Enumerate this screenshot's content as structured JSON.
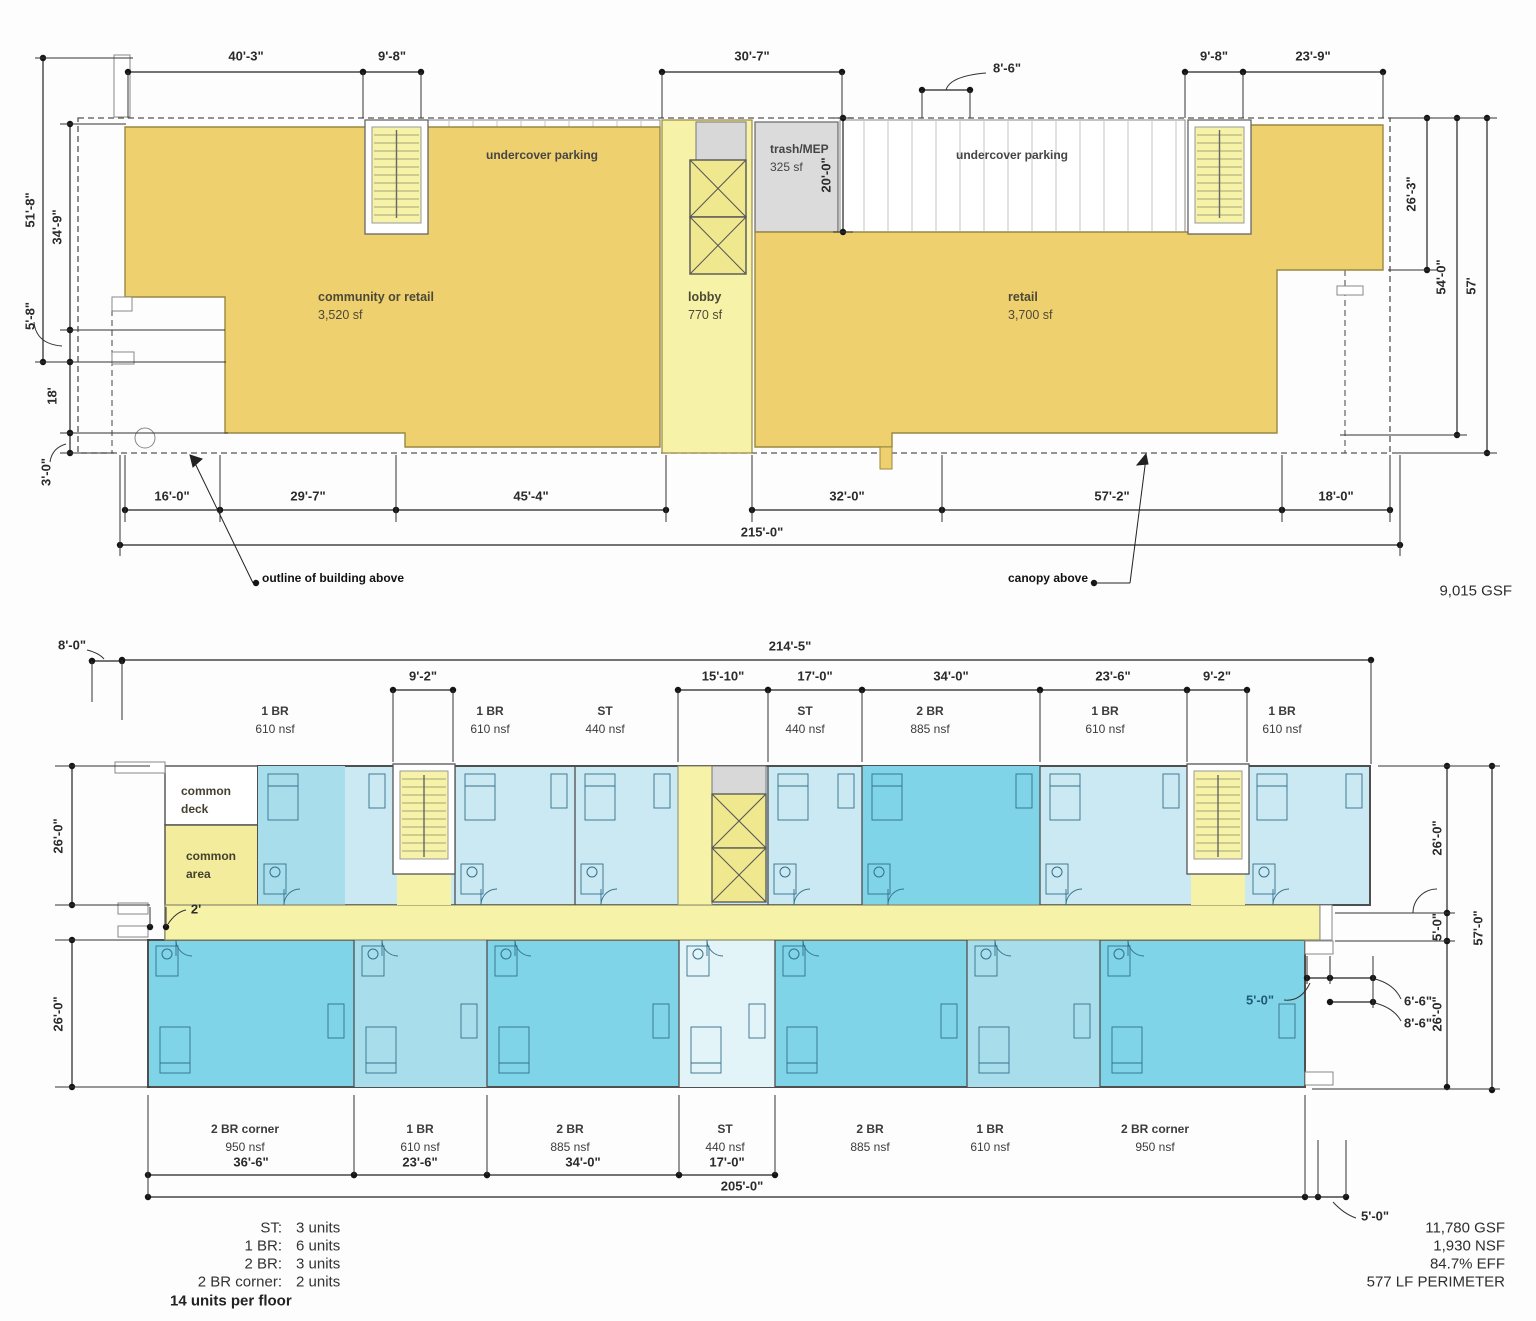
{
  "drawing_title": "residential building floor plans",
  "colors": {
    "retail_yellow": "#EFD06F",
    "pale_yellow": "#F6F2A8",
    "bright_yellow": "#F2EC9C",
    "elevator_yellow": "#F0E88E",
    "unit_light": "#CBE9F2",
    "unit_medium": "#A8DEEC",
    "unit_dark": "#7FD4E7",
    "unit_pale": "#E3F4F9",
    "gray_mep": "#DBDBDB",
    "wall": "#4f4f4f",
    "dim": "#222222",
    "furniture": "#34708A",
    "hatch": "#c6c6c6",
    "dim_text_blue": "#1d5b77"
  },
  "ground_floor": {
    "labels": [
      {
        "n": "dim-40-3",
        "t": "40'-3\"",
        "x": 246,
        "y": 56
      },
      {
        "n": "dim-9-8-left",
        "t": "9'-8\"",
        "x": 392,
        "y": 56
      },
      {
        "n": "dim-30-7",
        "t": "30'-7\"",
        "x": 752,
        "y": 56
      },
      {
        "n": "dim-8-6-top",
        "t": "8'-6\"",
        "x": 1007,
        "y": 68
      },
      {
        "n": "dim-9-8-right",
        "t": "9'-8\"",
        "x": 1214,
        "y": 56
      },
      {
        "n": "dim-23-9",
        "t": "23'-9\"",
        "x": 1313,
        "y": 56
      },
      {
        "n": "dim-51-8",
        "t": "51'-8\"",
        "x": 30,
        "y": 210,
        "r": -90
      },
      {
        "n": "dim-34-9",
        "t": "34'-9\"",
        "x": 57,
        "y": 227,
        "r": -90
      },
      {
        "n": "dim-5-8",
        "t": "5'-8\"",
        "x": 30,
        "y": 316,
        "r": -90
      },
      {
        "n": "dim-18",
        "t": "18'",
        "x": 52,
        "y": 396,
        "r": -90
      },
      {
        "n": "dim-3-0",
        "t": "3'-0\"",
        "x": 46,
        "y": 472,
        "r": -90
      },
      {
        "n": "dim-20-0",
        "t": "20'-0\"",
        "x": 826,
        "y": 175,
        "r": -90
      },
      {
        "n": "dim-26-3",
        "t": "26'-3\"",
        "x": 1411,
        "y": 194,
        "r": -90
      },
      {
        "n": "dim-54-0",
        "t": "54'-0\"",
        "x": 1441,
        "y": 277,
        "r": -90
      },
      {
        "n": "dim-57",
        "t": "57'",
        "x": 1471,
        "y": 286,
        "r": -90
      },
      {
        "n": "dim-16-0",
        "t": "16'-0\"",
        "x": 172,
        "y": 496
      },
      {
        "n": "dim-29-7",
        "t": "29'-7\"",
        "x": 308,
        "y": 496
      },
      {
        "n": "dim-45-4",
        "t": "45'-4\"",
        "x": 531,
        "y": 496
      },
      {
        "n": "dim-32-0",
        "t": "32'-0\"",
        "x": 847,
        "y": 496
      },
      {
        "n": "dim-57-2",
        "t": "57'-2\"",
        "x": 1112,
        "y": 496
      },
      {
        "n": "dim-18-0",
        "t": "18'-0\"",
        "x": 1336,
        "y": 496
      },
      {
        "n": "dim-215-0",
        "t": "215'-0\"",
        "x": 762,
        "y": 532
      },
      {
        "n": "room-community-retail",
        "t": "community or retail",
        "x": 318,
        "y": 297,
        "a": "left",
        "s": 12.5,
        "w": 700,
        "c": "#4d4936"
      },
      {
        "n": "room-community-retail-area",
        "t": "3,520 sf",
        "x": 318,
        "y": 315,
        "a": "left",
        "s": 12.5,
        "w": 400,
        "c": "#4d4936"
      },
      {
        "n": "room-lobby",
        "t": "lobby",
        "x": 688,
        "y": 297,
        "a": "left",
        "s": 12.5,
        "w": 700,
        "c": "#4d4936"
      },
      {
        "n": "room-lobby-area",
        "t": "770 sf",
        "x": 688,
        "y": 315,
        "a": "left",
        "s": 12.5,
        "w": 400,
        "c": "#4d4936"
      },
      {
        "n": "room-retail",
        "t": "retail",
        "x": 1008,
        "y": 297,
        "a": "left",
        "s": 12.5,
        "w": 700,
        "c": "#4d4936"
      },
      {
        "n": "room-retail-area",
        "t": "3,700 sf",
        "x": 1008,
        "y": 315,
        "a": "left",
        "s": 12.5,
        "w": 400,
        "c": "#4d4936"
      },
      {
        "n": "room-trash-mep",
        "t": "trash/MEP",
        "x": 770,
        "y": 149,
        "a": "left",
        "s": 12,
        "w": 700,
        "c": "#454545"
      },
      {
        "n": "room-trash-mep-area",
        "t": "325 sf",
        "x": 770,
        "y": 167,
        "a": "left",
        "s": 12,
        "w": 400,
        "c": "#454545"
      },
      {
        "n": "label-undercover-parking-left",
        "t": "undercover parking",
        "x": 542,
        "y": 155,
        "s": 12,
        "w": 600,
        "c": "#454545"
      },
      {
        "n": "label-undercover-parking-right",
        "t": "undercover parking",
        "x": 1012,
        "y": 155,
        "s": 12,
        "w": 600,
        "c": "#454545"
      },
      {
        "n": "note-outline-of-building-above",
        "t": "outline of building above",
        "x": 262,
        "y": 578,
        "a": "left",
        "s": 12,
        "w": 700,
        "c": "#111111"
      },
      {
        "n": "note-canopy-above",
        "t": "canopy above",
        "x": 1088,
        "y": 578,
        "a": "right",
        "s": 12,
        "w": 700,
        "c": "#111111"
      },
      {
        "n": "stat-ground-gsf",
        "t": "9,015 GSF",
        "x": 1512,
        "y": 591,
        "a": "right",
        "s": 15,
        "w": 400,
        "c": "#2e2e2e"
      }
    ]
  },
  "upper_floor": {
    "labels": [
      {
        "n": "dim-8-0",
        "t": "8'-0\"",
        "x": 72,
        "y": 645
      },
      {
        "n": "dim-214-5",
        "t": "214'-5\"",
        "x": 790,
        "y": 646
      },
      {
        "n": "dim-9-2-left",
        "t": "9'-2\"",
        "x": 423,
        "y": 676
      },
      {
        "n": "dim-15-10",
        "t": "15'-10\"",
        "x": 723,
        "y": 676
      },
      {
        "n": "dim-17-0-top",
        "t": "17'-0\"",
        "x": 815,
        "y": 676
      },
      {
        "n": "dim-34-0-top",
        "t": "34'-0\"",
        "x": 951,
        "y": 676
      },
      {
        "n": "dim-23-6-top",
        "t": "23'-6\"",
        "x": 1113,
        "y": 676
      },
      {
        "n": "dim-9-2-right",
        "t": "9'-2\"",
        "x": 1217,
        "y": 676
      },
      {
        "n": "dim-26-0-left-top",
        "t": "26'-0\"",
        "x": 58,
        "y": 836,
        "r": -90
      },
      {
        "n": "dim-26-0-left-bottom",
        "t": "26'-0\"",
        "x": 58,
        "y": 1014,
        "r": -90
      },
      {
        "n": "dim-2ft",
        "t": "2'",
        "x": 196,
        "y": 909,
        "s": 13,
        "w": 600
      },
      {
        "n": "dim-26-0-right-top",
        "t": "26'-0\"",
        "x": 1437,
        "y": 838,
        "r": -90
      },
      {
        "n": "dim-5-0-right",
        "t": "5'-0\"",
        "x": 1437,
        "y": 927,
        "r": -90
      },
      {
        "n": "dim-26-0-right-bottom",
        "t": "26'-0\"",
        "x": 1437,
        "y": 1014,
        "r": -90
      },
      {
        "n": "dim-57-0",
        "t": "57'-0\"",
        "x": 1478,
        "y": 928,
        "r": -90
      },
      {
        "n": "dim-6-6",
        "t": "6'-6\"",
        "x": 1404,
        "y": 1001,
        "a": "left"
      },
      {
        "n": "dim-8-6-right",
        "t": "8'-6\"",
        "x": 1404,
        "y": 1023,
        "a": "left"
      },
      {
        "n": "dim-5-0-in-unit",
        "t": "5'-0\"",
        "x": 1246,
        "y": 1000,
        "a": "left",
        "s": 13,
        "w": 700,
        "c": "#1d5b77"
      },
      {
        "n": "dim-36-6",
        "t": "36'-6\"",
        "x": 251,
        "y": 1162
      },
      {
        "n": "dim-23-6-bottom",
        "t": "23'-6\"",
        "x": 420,
        "y": 1162
      },
      {
        "n": "dim-34-0-bottom",
        "t": "34'-0\"",
        "x": 583,
        "y": 1162
      },
      {
        "n": "dim-17-0-bottom",
        "t": "17'-0\"",
        "x": 727,
        "y": 1162
      },
      {
        "n": "dim-205-0",
        "t": "205'-0\"",
        "x": 742,
        "y": 1186
      },
      {
        "n": "dim-5-0-bottom-right",
        "t": "5'-0\"",
        "x": 1361,
        "y": 1216,
        "a": "left"
      },
      {
        "n": "unit-top-1br-a",
        "t": "1 BR",
        "x": 275,
        "y": 711,
        "s": 12,
        "w": 700,
        "c": "#3c3c3c"
      },
      {
        "n": "unit-top-1br-a-area",
        "t": "610 nsf",
        "x": 275,
        "y": 729,
        "s": 12,
        "w": 400,
        "c": "#3c3c3c"
      },
      {
        "n": "unit-top-1br-b",
        "t": "1 BR",
        "x": 490,
        "y": 711,
        "s": 12,
        "w": 700,
        "c": "#3c3c3c"
      },
      {
        "n": "unit-top-1br-b-area",
        "t": "610 nsf",
        "x": 490,
        "y": 729,
        "s": 12,
        "w": 400,
        "c": "#3c3c3c"
      },
      {
        "n": "unit-top-st-a",
        "t": "ST",
        "x": 605,
        "y": 711,
        "s": 12,
        "w": 700,
        "c": "#3c3c3c"
      },
      {
        "n": "unit-top-st-a-area",
        "t": "440 nsf",
        "x": 605,
        "y": 729,
        "s": 12,
        "w": 400,
        "c": "#3c3c3c"
      },
      {
        "n": "unit-top-st-b",
        "t": "ST",
        "x": 805,
        "y": 711,
        "s": 12,
        "w": 700,
        "c": "#3c3c3c"
      },
      {
        "n": "unit-top-st-b-area",
        "t": "440 nsf",
        "x": 805,
        "y": 729,
        "s": 12,
        "w": 400,
        "c": "#3c3c3c"
      },
      {
        "n": "unit-top-2br",
        "t": "2 BR",
        "x": 930,
        "y": 711,
        "s": 12,
        "w": 700,
        "c": "#3c3c3c"
      },
      {
        "n": "unit-top-2br-area",
        "t": "885 nsf",
        "x": 930,
        "y": 729,
        "s": 12,
        "w": 400,
        "c": "#3c3c3c"
      },
      {
        "n": "unit-top-1br-c",
        "t": "1 BR",
        "x": 1105,
        "y": 711,
        "s": 12,
        "w": 700,
        "c": "#3c3c3c"
      },
      {
        "n": "unit-top-1br-c-area",
        "t": "610 nsf",
        "x": 1105,
        "y": 729,
        "s": 12,
        "w": 400,
        "c": "#3c3c3c"
      },
      {
        "n": "unit-top-1br-d",
        "t": "1 BR",
        "x": 1282,
        "y": 711,
        "s": 12,
        "w": 700,
        "c": "#3c3c3c"
      },
      {
        "n": "unit-top-1br-d-area",
        "t": "610 nsf",
        "x": 1282,
        "y": 729,
        "s": 12,
        "w": 400,
        "c": "#3c3c3c"
      },
      {
        "n": "unit-bottom-2br-corner-a",
        "t": "2 BR corner",
        "x": 245,
        "y": 1129,
        "s": 12,
        "w": 700,
        "c": "#3c3c3c"
      },
      {
        "n": "unit-bottom-2br-corner-a-area",
        "t": "950 nsf",
        "x": 245,
        "y": 1147,
        "s": 12,
        "w": 400,
        "c": "#3c3c3c"
      },
      {
        "n": "unit-bottom-1br-a",
        "t": "1 BR",
        "x": 420,
        "y": 1129,
        "s": 12,
        "w": 700,
        "c": "#3c3c3c"
      },
      {
        "n": "unit-bottom-1br-a-area",
        "t": "610 nsf",
        "x": 420,
        "y": 1147,
        "s": 12,
        "w": 400,
        "c": "#3c3c3c"
      },
      {
        "n": "unit-bottom-2br-a",
        "t": "2 BR",
        "x": 570,
        "y": 1129,
        "s": 12,
        "w": 700,
        "c": "#3c3c3c"
      },
      {
        "n": "unit-bottom-2br-a-area",
        "t": "885 nsf",
        "x": 570,
        "y": 1147,
        "s": 12,
        "w": 400,
        "c": "#3c3c3c"
      },
      {
        "n": "unit-bottom-st",
        "t": "ST",
        "x": 725,
        "y": 1129,
        "s": 12,
        "w": 700,
        "c": "#3c3c3c"
      },
      {
        "n": "unit-bottom-st-area",
        "t": "440 nsf",
        "x": 725,
        "y": 1147,
        "s": 12,
        "w": 400,
        "c": "#3c3c3c"
      },
      {
        "n": "unit-bottom-2br-b",
        "t": "2 BR",
        "x": 870,
        "y": 1129,
        "s": 12,
        "w": 700,
        "c": "#3c3c3c"
      },
      {
        "n": "unit-bottom-2br-b-area",
        "t": "885 nsf",
        "x": 870,
        "y": 1147,
        "s": 12,
        "w": 400,
        "c": "#3c3c3c"
      },
      {
        "n": "unit-bottom-1br-b",
        "t": "1 BR",
        "x": 990,
        "y": 1129,
        "s": 12,
        "w": 700,
        "c": "#3c3c3c"
      },
      {
        "n": "unit-bottom-1br-b-area",
        "t": "610 nsf",
        "x": 990,
        "y": 1147,
        "s": 12,
        "w": 400,
        "c": "#3c3c3c"
      },
      {
        "n": "unit-bottom-2br-corner-b",
        "t": "2 BR corner",
        "x": 1155,
        "y": 1129,
        "s": 12,
        "w": 700,
        "c": "#3c3c3c"
      },
      {
        "n": "unit-bottom-2br-corner-b-area",
        "t": "950 nsf",
        "x": 1155,
        "y": 1147,
        "s": 12,
        "w": 400,
        "c": "#3c3c3c"
      },
      {
        "n": "label-common-deck-line1",
        "t": "common",
        "x": 181,
        "y": 791,
        "a": "left",
        "s": 12,
        "w": 700,
        "c": "#44412f"
      },
      {
        "n": "label-common-deck-line2",
        "t": "deck",
        "x": 181,
        "y": 809,
        "a": "left",
        "s": 12,
        "w": 700,
        "c": "#44412f"
      },
      {
        "n": "label-common-area-line1",
        "t": "common",
        "x": 186,
        "y": 856,
        "a": "left",
        "s": 12,
        "w": 700,
        "c": "#44412f"
      },
      {
        "n": "label-common-area-line2",
        "t": "area",
        "x": 186,
        "y": 874,
        "a": "left",
        "s": 12,
        "w": 700,
        "c": "#44412f"
      },
      {
        "n": "legend-st-label",
        "t": "ST:",
        "x": 282,
        "y": 1228,
        "a": "right",
        "s": 15,
        "w": 400,
        "c": "#333333"
      },
      {
        "n": "legend-st-value",
        "t": "3 units",
        "x": 296,
        "y": 1228,
        "a": "left",
        "s": 15,
        "w": 400,
        "c": "#333333"
      },
      {
        "n": "legend-1br-label",
        "t": "1 BR:",
        "x": 282,
        "y": 1246,
        "a": "right",
        "s": 15,
        "w": 400,
        "c": "#333333"
      },
      {
        "n": "legend-1br-value",
        "t": "6 units",
        "x": 296,
        "y": 1246,
        "a": "left",
        "s": 15,
        "w": 400,
        "c": "#333333"
      },
      {
        "n": "legend-2br-label",
        "t": "2 BR:",
        "x": 282,
        "y": 1264,
        "a": "right",
        "s": 15,
        "w": 400,
        "c": "#333333"
      },
      {
        "n": "legend-2br-value",
        "t": "3 units",
        "x": 296,
        "y": 1264,
        "a": "left",
        "s": 15,
        "w": 400,
        "c": "#333333"
      },
      {
        "n": "legend-2br-corner-label",
        "t": "2 BR corner:",
        "x": 282,
        "y": 1282,
        "a": "right",
        "s": 15,
        "w": 400,
        "c": "#333333"
      },
      {
        "n": "legend-2br-corner-value",
        "t": "2 units",
        "x": 296,
        "y": 1282,
        "a": "left",
        "s": 15,
        "w": 400,
        "c": "#333333"
      },
      {
        "n": "legend-total",
        "t": "14 units per floor",
        "x": 170,
        "y": 1301,
        "a": "left",
        "s": 15,
        "w": 700,
        "c": "#222222"
      },
      {
        "n": "stat-upper-gsf",
        "t": "11,780 GSF",
        "x": 1505,
        "y": 1228,
        "a": "right",
        "s": 15,
        "w": 400,
        "c": "#2e2e2e"
      },
      {
        "n": "stat-upper-nsf",
        "t": "1,930 NSF",
        "x": 1505,
        "y": 1246,
        "a": "right",
        "s": 15,
        "w": 400,
        "c": "#2e2e2e"
      },
      {
        "n": "stat-upper-eff",
        "t": "84.7% EFF",
        "x": 1505,
        "y": 1264,
        "a": "right",
        "s": 15,
        "w": 400,
        "c": "#2e2e2e"
      },
      {
        "n": "stat-upper-perimeter",
        "t": "577  LF PERIMETER",
        "x": 1505,
        "y": 1282,
        "a": "right",
        "s": 15,
        "w": 400,
        "c": "#2e2e2e"
      }
    ]
  }
}
